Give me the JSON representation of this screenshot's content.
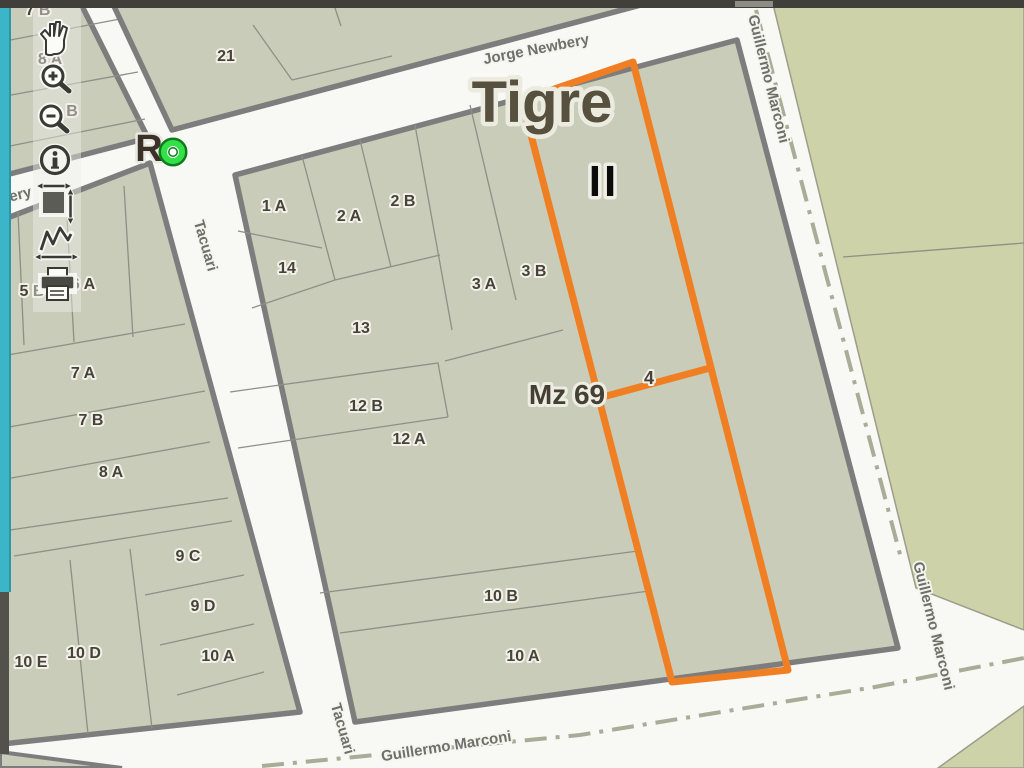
{
  "window": {
    "top_bar_color": "#403f39",
    "side_bar_color": "#3cb5c8"
  },
  "map": {
    "city_label": "Tigre",
    "zone_label": "II",
    "marker_label": "R",
    "block_label": "Mz 69",
    "highlight_parcel_label": "4",
    "streets": {
      "jorge_newbery": "Jorge Newbery",
      "newbery_partial": "bery",
      "tacuari_upper": "Tacuari",
      "tacuari_lower": "Tacuari",
      "marconi_bottom": "Guillermo Marconi",
      "marconi_right_upper": "Guillermo Marconi",
      "marconi_right_lower": "Guillermo Marconi"
    },
    "parcel_labels": {
      "tl_7b": "7 B",
      "tl_8a": "8 A",
      "tl_b": "B",
      "b21": "21",
      "p1a": "1 A",
      "p2a": "2 A",
      "p2b": "2 B",
      "p14": "14",
      "p3a": "3 A",
      "p3b": "3 B",
      "p13": "13",
      "p12b": "12 B",
      "p12a": "12 A",
      "p10b": "10 B",
      "p10a": "10 A",
      "l5b": "5 B",
      "l6a": "6 A",
      "l7a": "7 A",
      "l7b": "7 B",
      "l8a": "8 A",
      "l9c": "9 C",
      "l9d": "9 D",
      "l10a": "10 A",
      "l10d": "10 D",
      "l10e": "10 E"
    },
    "colors": {
      "highlight_orange": "#ef7f22",
      "block_fill": "#c8ccb8",
      "open_area_fill": "#cdd2a8",
      "street_fill": "#f8f8f5",
      "street_casing": "#7d7d7d",
      "parcel_line": "#8e9086",
      "parcel_label": "#474339",
      "street_label": "#70706a",
      "marker_green": "#33e04a"
    }
  },
  "toolbar": {
    "tools": [
      {
        "name": "pan",
        "icon": "hand-icon"
      },
      {
        "name": "zoom-in",
        "icon": "magnifier-plus-icon"
      },
      {
        "name": "zoom-out",
        "icon": "magnifier-minus-icon"
      },
      {
        "name": "identify",
        "icon": "info-icon"
      },
      {
        "name": "full-extent",
        "icon": "extent-square-icon"
      },
      {
        "name": "measure",
        "icon": "measure-path-icon"
      },
      {
        "name": "print",
        "icon": "printer-icon"
      }
    ]
  }
}
